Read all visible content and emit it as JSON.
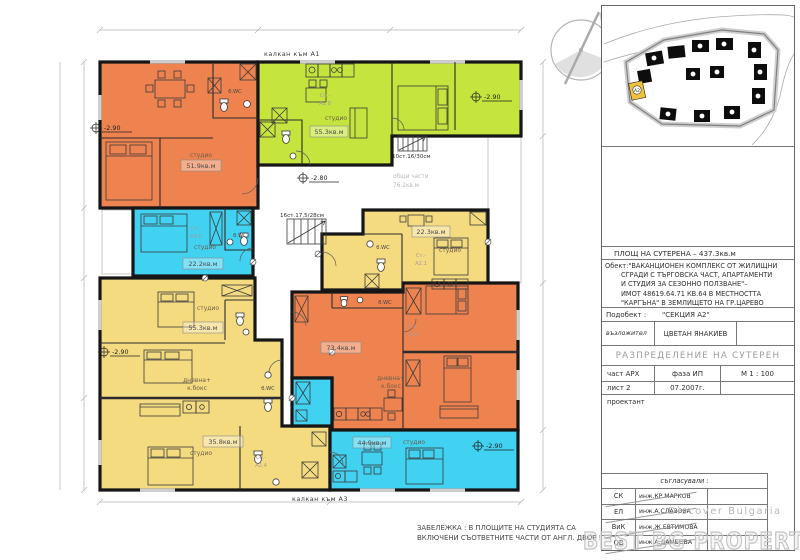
{
  "drawing": {
    "top_edge_label": "калкан към А1",
    "bottom_edge_label": "калкан към А3",
    "note": {
      "line1": "ЗАБЕЛЕЖКА :  В ПЛОЩИТЕ НА СТУДИЯТА СА",
      "line2": "ВКЛЮЧЕНИ СЪОТВЕТНИТЕ ЧАСТИ ОТ АНГЛ.  ДВОР !"
    },
    "common_area": {
      "line1": "общи части",
      "line2": "76.2кв.м"
    },
    "stairs": {
      "upper": "10ст.16/30см",
      "lower": "16ст.17,5/28см"
    },
    "elevations": {
      "minus280": "-2.80",
      "minus290": "-2.90"
    },
    "rooms": {
      "studio_tl": {
        "type": "студио",
        "area": "51.9кв.м",
        "wc": "б.WC"
      },
      "studio_top": {
        "type": "студио",
        "area": "55.3кв.м",
        "tag1": "Сп.-",
        "tag2": "А2.8"
      },
      "studio_cyan": {
        "type": "студио",
        "area": "22.2кв.м",
        "tag1": "Сп.-",
        "tag2": "А2.6",
        "wc": "б.WC"
      },
      "studio_mid": {
        "type": "студио",
        "area": "22.3кв.м",
        "tag1": "Ст.-",
        "tag2": "А2.1",
        "wc": "б.WC"
      },
      "studio_left1": {
        "type": "студио",
        "area": "55.3кв.м"
      },
      "studio_left2": {
        "type": "студио",
        "area": "35.8кв.м",
        "living1": "дневна+",
        "living2": "к.бокс",
        "wc": "б.WC",
        "tag1": "Сп.-",
        "tag2": "А2.4"
      },
      "apt_mid": {
        "area": "73.4кв.м",
        "living1": "дневна+",
        "living2": "к.бокс",
        "wc": "б.WC",
        "tag1": "Сп.-",
        "tag2": "А2.2"
      },
      "studio_bottom": {
        "type": "студио",
        "area": "44.9кв.м"
      }
    }
  },
  "site_plan": {
    "highlight_label": "А2"
  },
  "title_block": {
    "area_row": "ПЛОЩ НА СУТЕРЕНА –  437.3кв.м",
    "object_label": "Обект:",
    "object_lines": [
      "\"ВАКАНЦИОНЕН КОМПЛЕКС ОТ ЖИЛИЩНИ",
      "СГРАДИ С ТЪРГОВСКА ЧАСТ, АПАРТАМЕНТИ",
      "И СТУДИЯ ЗА СЕЗОННО ПОЛЗВАНЕ\"–",
      "ИМОТ 48619.64.71 КВ.64 В МЕСТНОСТТА",
      "\"КАРГЪНА\" В ЗЕМЛИЩЕТО НА ГР.ЦАРЕВО"
    ],
    "subobject_label": "Подобект :",
    "subobject_value": "\"СЕКЦИЯ А2\"",
    "client_label": "възложител",
    "client_value": "ЦВЕТАН ЯНАКИЕВ",
    "sheet_title": "РАЗПРЕДЕЛЕНИЕ  НА  СУТЕРЕН",
    "part_label": "част АРХ",
    "phase_label": "фаза ИП",
    "scale_label": "М 1 : 100",
    "sheet_label": "лист 2",
    "date_label": "07.2007г.",
    "designer_label": "проектант",
    "approvals_label": "съгласували :",
    "approvals": [
      {
        "code": "СК",
        "name": "инж.КР.МАРКОВ"
      },
      {
        "code": "ЕЛ",
        "name": "инж.А.СЛАВОВА"
      },
      {
        "code": "ВиК",
        "name": "инж.Ж.ЕВТИМОВА"
      },
      {
        "code": "ОВ",
        "name": "инж.А.ДАМБОВА"
      }
    ]
  },
  "watermark": {
    "small": "Discover Bulgaria",
    "large": "BEST BG PROPERTIES"
  }
}
